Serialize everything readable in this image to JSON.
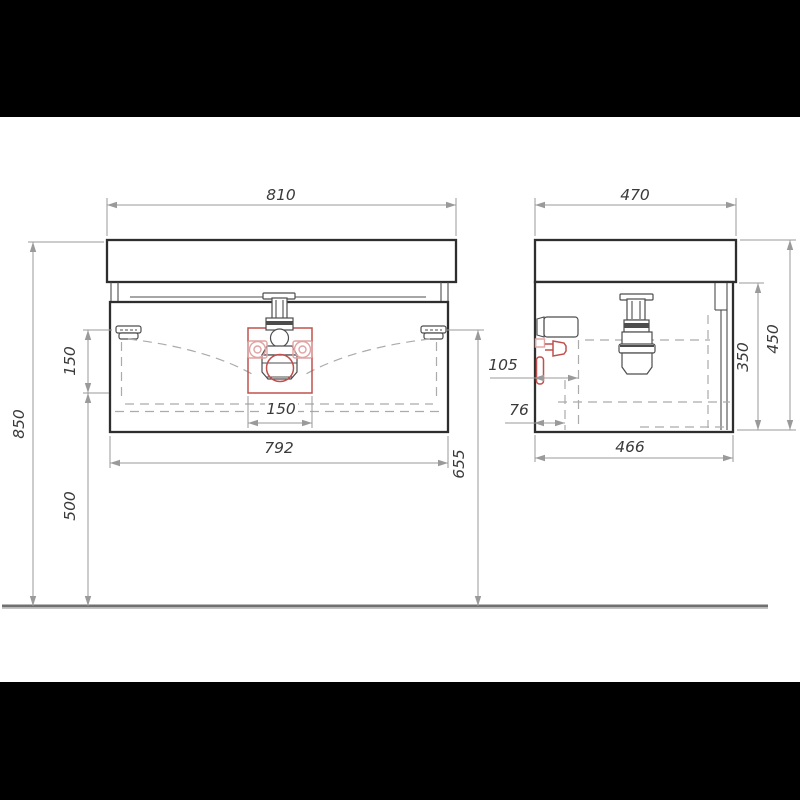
{
  "dims": {
    "d810": "810",
    "d470": "470",
    "d850": "850",
    "d150_left": "150",
    "d500": "500",
    "d655": "655",
    "d792": "792",
    "d150_drain": "150",
    "d105": "105",
    "d76": "76",
    "d466": "466",
    "d350": "350",
    "d450": "450"
  },
  "colors": {
    "line": "#2e2e2e",
    "line2": "#4d4d4d",
    "dim": "#9a9a9a",
    "dash": "#ababab",
    "red": "#c0504d",
    "redlight": "#dfa3a3",
    "text": "#3a3a3a",
    "floor": "#707070",
    "letterbox": "#000000",
    "paper": "#ffffff"
  }
}
